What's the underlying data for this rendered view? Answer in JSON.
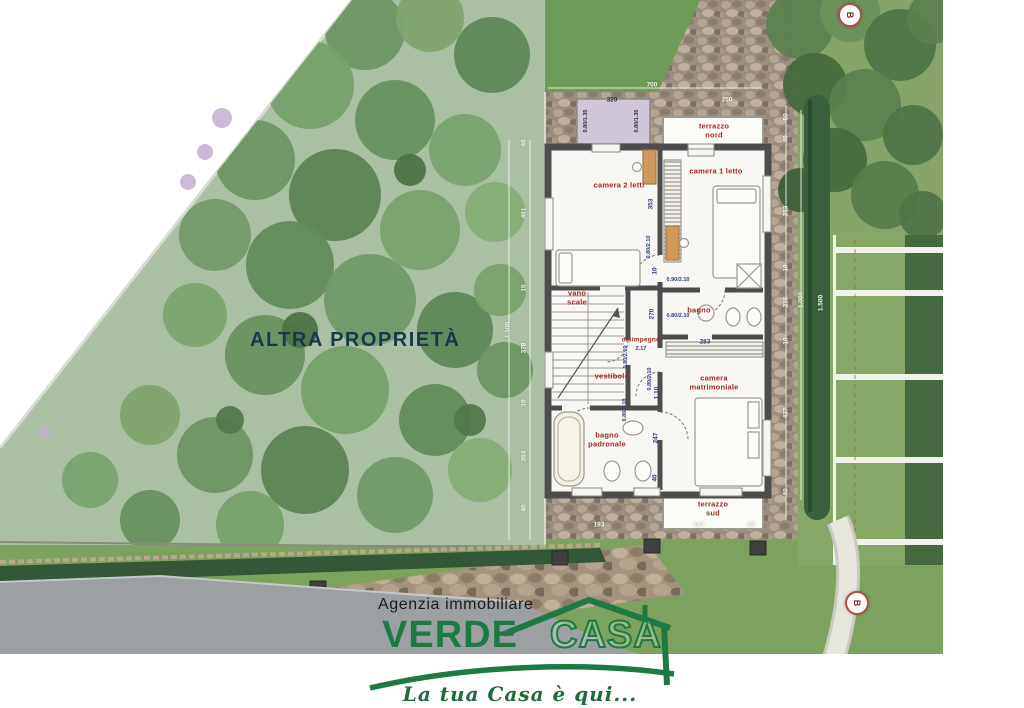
{
  "labels": {
    "other_property": "ALTRA PROPRIETÀ",
    "marker_top": "B",
    "marker_bottom": "B"
  },
  "rooms": [
    {
      "id": "terrazzo-nord",
      "label": "terrazzo\nnord"
    },
    {
      "id": "camera-2-letti",
      "label": "camera 2 letti"
    },
    {
      "id": "camera-1-letto",
      "label": "camera 1 letto"
    },
    {
      "id": "vano-scale",
      "label": "vano\nscale"
    },
    {
      "id": "bagno",
      "label": "bagno"
    },
    {
      "id": "disimpegno",
      "label": "disimpegno"
    },
    {
      "id": "vestibolo",
      "label": "vestibolo"
    },
    {
      "id": "camera-matrimoniale",
      "label": "camera\nmatrimoniale"
    },
    {
      "id": "bagno-padronale",
      "label": "bagno\npadronale"
    },
    {
      "id": "terrazzo-sud",
      "label": "terrazzo\nsud"
    }
  ],
  "dims": [
    {
      "t": "40",
      "x": 524,
      "y": 143,
      "r": 1,
      "c": "w"
    },
    {
      "t": "491",
      "x": 524,
      "y": 213,
      "r": 1,
      "c": "w"
    },
    {
      "t": "10",
      "x": 524,
      "y": 288,
      "r": 1,
      "c": "w"
    },
    {
      "t": "378",
      "x": 524,
      "y": 348,
      "r": 1,
      "c": "w"
    },
    {
      "t": "10",
      "x": 524,
      "y": 403,
      "r": 1,
      "c": "w"
    },
    {
      "t": "203",
      "x": 524,
      "y": 456,
      "r": 1,
      "c": "w"
    },
    {
      "t": "40",
      "x": 524,
      "y": 508,
      "r": 1,
      "c": "w"
    },
    {
      "t": "1.100",
      "x": 508,
      "y": 330,
      "r": 1,
      "c": "w"
    },
    {
      "t": "700",
      "x": 652,
      "y": 85,
      "c": "w"
    },
    {
      "t": "320",
      "x": 612,
      "y": 100,
      "c": "d"
    },
    {
      "t": "250",
      "x": 727,
      "y": 100,
      "c": "w"
    },
    {
      "t": "0.80/1.35",
      "x": 586,
      "y": 121,
      "r": 1,
      "c": "d",
      "s": 1
    },
    {
      "t": "0.80/1.35",
      "x": 637,
      "y": 121,
      "r": 1,
      "c": "d",
      "s": 1
    },
    {
      "t": "50",
      "x": 786,
      "y": 117,
      "r": 1,
      "c": "w"
    },
    {
      "t": "40",
      "x": 786,
      "y": 139,
      "r": 1,
      "c": "w"
    },
    {
      "t": "313",
      "x": 786,
      "y": 211,
      "r": 1,
      "c": "w"
    },
    {
      "t": "10",
      "x": 786,
      "y": 268,
      "r": 1,
      "c": "w"
    },
    {
      "t": "215",
      "x": 786,
      "y": 302,
      "r": 1,
      "c": "w"
    },
    {
      "t": "10",
      "x": 786,
      "y": 341,
      "r": 1,
      "c": "w"
    },
    {
      "t": "437",
      "x": 786,
      "y": 413,
      "r": 1,
      "c": "w"
    },
    {
      "t": "40",
      "x": 786,
      "y": 492,
      "r": 1,
      "c": "w"
    },
    {
      "t": "1.000",
      "x": 801,
      "y": 300,
      "r": 1,
      "c": "w"
    },
    {
      "t": "1.500",
      "x": 821,
      "y": 303,
      "r": 1,
      "c": "w"
    },
    {
      "t": "353",
      "x": 651,
      "y": 204,
      "r": 1,
      "c": "b"
    },
    {
      "t": "0.80/2.10",
      "x": 649,
      "y": 247,
      "r": 1,
      "c": "b",
      "s": 1
    },
    {
      "t": "10",
      "x": 655,
      "y": 271,
      "r": 1,
      "c": "b"
    },
    {
      "t": "0.90/2.10",
      "x": 678,
      "y": 280,
      "c": "b",
      "s": 1
    },
    {
      "t": "270",
      "x": 652,
      "y": 314,
      "r": 1,
      "c": "b"
    },
    {
      "t": "0.80/2.10",
      "x": 678,
      "y": 316,
      "c": "b",
      "s": 1
    },
    {
      "t": "283",
      "x": 705,
      "y": 342,
      "c": "b"
    },
    {
      "t": "2.17",
      "x": 641,
      "y": 349,
      "c": "b",
      "s": 1
    },
    {
      "t": "0.80/2.10",
      "x": 626,
      "y": 357,
      "r": 1,
      "c": "b",
      "s": 1
    },
    {
      "t": "0.80/2.10",
      "x": 650,
      "y": 379,
      "r": 1,
      "c": "b",
      "s": 1
    },
    {
      "t": "1.10",
      "x": 657,
      "y": 393,
      "r": 1,
      "c": "b"
    },
    {
      "t": "0.80/2.10",
      "x": 625,
      "y": 410,
      "r": 1,
      "c": "b",
      "s": 1
    },
    {
      "t": "247",
      "x": 656,
      "y": 438,
      "r": 1,
      "c": "b"
    },
    {
      "t": "40",
      "x": 655,
      "y": 478,
      "r": 1,
      "c": "b"
    },
    {
      "t": "193",
      "x": 599,
      "y": 525,
      "c": "w"
    },
    {
      "t": "147",
      "x": 699,
      "y": 525,
      "c": "w"
    },
    {
      "t": "40",
      "x": 751,
      "y": 525,
      "c": "w"
    }
  ],
  "branding": {
    "agency_line": "Agenzia immobiliare",
    "logo_word1": "VERDE",
    "logo_word2": "CASA",
    "tagline": "La tua Casa è qui...",
    "logo_green": "#1d7a45"
  },
  "site": {
    "trees": [
      {
        "x": 365,
        "y": 30,
        "r": 40,
        "c": "#6e9465"
      },
      {
        "x": 430,
        "y": 18,
        "r": 34,
        "c": "#7fa36f"
      },
      {
        "x": 492,
        "y": 55,
        "r": 38,
        "c": "#5f8758"
      },
      {
        "x": 310,
        "y": 85,
        "r": 44,
        "c": "#76a06c"
      },
      {
        "x": 395,
        "y": 120,
        "r": 40,
        "c": "#679061"
      },
      {
        "x": 465,
        "y": 150,
        "r": 36,
        "c": "#7aa271"
      },
      {
        "x": 255,
        "y": 160,
        "r": 40,
        "c": "#6e9465"
      },
      {
        "x": 335,
        "y": 195,
        "r": 46,
        "c": "#5d8356"
      },
      {
        "x": 420,
        "y": 230,
        "r": 40,
        "c": "#79a16e"
      },
      {
        "x": 495,
        "y": 212,
        "r": 30,
        "c": "#86ad78"
      },
      {
        "x": 215,
        "y": 235,
        "r": 36,
        "c": "#75996a"
      },
      {
        "x": 290,
        "y": 265,
        "r": 44,
        "c": "#638b5c"
      },
      {
        "x": 370,
        "y": 300,
        "r": 46,
        "c": "#71996a"
      },
      {
        "x": 455,
        "y": 330,
        "r": 38,
        "c": "#5f8758"
      },
      {
        "x": 195,
        "y": 315,
        "r": 32,
        "c": "#7ca471"
      },
      {
        "x": 265,
        "y": 355,
        "r": 40,
        "c": "#6a9162"
      },
      {
        "x": 345,
        "y": 390,
        "r": 44,
        "c": "#76a06c"
      },
      {
        "x": 435,
        "y": 420,
        "r": 36,
        "c": "#638b5c"
      },
      {
        "x": 150,
        "y": 415,
        "r": 30,
        "c": "#7fa36f"
      },
      {
        "x": 215,
        "y": 455,
        "r": 38,
        "c": "#6e9465"
      },
      {
        "x": 305,
        "y": 470,
        "r": 44,
        "c": "#5d8356"
      },
      {
        "x": 395,
        "y": 495,
        "r": 38,
        "c": "#71996a"
      },
      {
        "x": 90,
        "y": 480,
        "r": 28,
        "c": "#7aa271"
      },
      {
        "x": 150,
        "y": 520,
        "r": 30,
        "c": "#679061"
      },
      {
        "x": 250,
        "y": 525,
        "r": 34,
        "c": "#76a06c"
      },
      {
        "x": 480,
        "y": 470,
        "r": 32,
        "c": "#86ad78"
      },
      {
        "x": 505,
        "y": 370,
        "r": 28,
        "c": "#6e9465"
      },
      {
        "x": 500,
        "y": 290,
        "r": 26,
        "c": "#79a16e"
      },
      {
        "x": 300,
        "y": 330,
        "r": 18,
        "c": "#4e7248"
      },
      {
        "x": 410,
        "y": 170,
        "r": 16,
        "c": "#4e7248"
      },
      {
        "x": 230,
        "y": 420,
        "r": 14,
        "c": "#54784e"
      },
      {
        "x": 470,
        "y": 420,
        "r": 16,
        "c": "#54784e"
      }
    ],
    "trees_ne": [
      {
        "x": 800,
        "y": 25,
        "r": 34,
        "c": "#5c8150"
      },
      {
        "x": 850,
        "y": 12,
        "r": 30,
        "c": "#6a9158"
      },
      {
        "x": 900,
        "y": 45,
        "r": 36,
        "c": "#4f7547"
      },
      {
        "x": 933,
        "y": 18,
        "r": 26,
        "c": "#5c8150"
      },
      {
        "x": 815,
        "y": 85,
        "r": 32,
        "c": "#46693f"
      },
      {
        "x": 865,
        "y": 105,
        "r": 36,
        "c": "#5c8150"
      },
      {
        "x": 913,
        "y": 135,
        "r": 30,
        "c": "#4f7547"
      },
      {
        "x": 835,
        "y": 160,
        "r": 32,
        "c": "#46693f"
      },
      {
        "x": 885,
        "y": 195,
        "r": 34,
        "c": "#587c4c"
      },
      {
        "x": 923,
        "y": 215,
        "r": 24,
        "c": "#4f7547"
      },
      {
        "x": 800,
        "y": 190,
        "r": 22,
        "c": "#3f5f39"
      }
    ],
    "lavender": [
      {
        "x": 222,
        "y": 118,
        "r": 10
      },
      {
        "x": 205,
        "y": 152,
        "r": 8
      },
      {
        "x": 188,
        "y": 182,
        "r": 8
      },
      {
        "x": 45,
        "y": 432,
        "r": 6
      }
    ],
    "parking_lines_y": [
      250,
      293,
      377,
      460,
      542
    ],
    "posts": [
      {
        "x": 170,
        "y": 605
      },
      {
        "x": 238,
        "y": 597
      },
      {
        "x": 318,
        "y": 588
      },
      {
        "x": 560,
        "y": 558
      },
      {
        "x": 652,
        "y": 546
      },
      {
        "x": 758,
        "y": 548
      }
    ]
  },
  "colors": {
    "label_red": "#9c2b25",
    "dim_blue": "#2b3a7e",
    "navy": "#16394e",
    "wall": "#4d4d4d"
  }
}
